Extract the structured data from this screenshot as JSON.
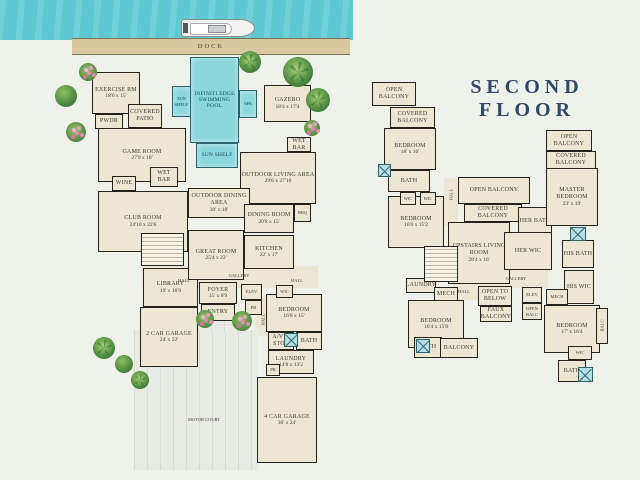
{
  "scene": {
    "dock_label": "DOCK",
    "second_floor_title": "SECOND FLOOR"
  },
  "palette": {
    "water": "#5fc9d3",
    "pool": "#8ad6dd",
    "room_fill": "#ece6d3",
    "wall": "#23231c",
    "background": "#eef2eb",
    "dock": "#d8c7a0",
    "title_navy": "#30486a"
  },
  "first_floor": {
    "rooms": [
      {
        "id": "hall-slab",
        "x": 142,
        "y": 266,
        "w": 176,
        "h": 22,
        "type": "slab"
      },
      {
        "id": "hall-slab-vert",
        "x": 255,
        "y": 296,
        "w": 14,
        "h": 40,
        "type": "slab"
      },
      {
        "id": "motor-court",
        "x": 134,
        "y": 330,
        "w": 124,
        "h": 140,
        "type": "paved"
      },
      {
        "id": "entry-walk",
        "x": 198,
        "y": 320,
        "w": 40,
        "h": 12,
        "type": "paved"
      },
      {
        "id": "exercise-rm",
        "label": "EXERCISE RM",
        "dims": "18'6 x 15'",
        "x": 92,
        "y": 72,
        "w": 48,
        "h": 42,
        "type": "room"
      },
      {
        "id": "pwdr",
        "label": "PWDR",
        "x": 95,
        "y": 114,
        "w": 28,
        "h": 15,
        "type": "room"
      },
      {
        "id": "covered-patio",
        "label": "COVERED PATIO",
        "x": 128,
        "y": 104,
        "w": 34,
        "h": 24,
        "type": "room"
      },
      {
        "id": "game-room",
        "label": "GAME ROOM",
        "dims": "27'9 x 18'",
        "x": 98,
        "y": 128,
        "w": 88,
        "h": 54,
        "type": "room"
      },
      {
        "id": "wine",
        "label": "WINE",
        "x": 112,
        "y": 176,
        "w": 24,
        "h": 15,
        "type": "room"
      },
      {
        "id": "wet-bar-1",
        "label": "WET BAR",
        "x": 150,
        "y": 167,
        "w": 28,
        "h": 20,
        "type": "room"
      },
      {
        "id": "club-room",
        "label": "CLUB ROOM",
        "dims": "24'10 x 22'6",
        "x": 98,
        "y": 191,
        "w": 90,
        "h": 61,
        "type": "room"
      },
      {
        "id": "library",
        "label": "LIBRARY",
        "dims": "19' x 16'9",
        "x": 143,
        "y": 268,
        "w": 55,
        "h": 39,
        "type": "room"
      },
      {
        "id": "two-car-garage",
        "label": "2 CAR GARAGE",
        "dims": "24' x 22'",
        "x": 140,
        "y": 307,
        "w": 58,
        "h": 60,
        "type": "room"
      },
      {
        "id": "gazebo",
        "label": "GAZEBO",
        "dims": "18'4 x 17'4",
        "x": 264,
        "y": 85,
        "w": 47,
        "h": 37,
        "type": "room"
      },
      {
        "id": "outdoor-living",
        "label": "OUTDOOR LIVING AREA",
        "dims": "29'6 x 27'10",
        "x": 240,
        "y": 152,
        "w": 76,
        "h": 52,
        "type": "room"
      },
      {
        "id": "wet-bar-2",
        "label": "WET BAR",
        "x": 287,
        "y": 137,
        "w": 24,
        "h": 15,
        "type": "room"
      },
      {
        "id": "outdoor-dining",
        "label": "OUTDOOR DINING AREA",
        "dims": "30' x 18'",
        "x": 188,
        "y": 188,
        "w": 62,
        "h": 30,
        "type": "room"
      },
      {
        "id": "dining-room",
        "label": "DINING ROOM",
        "dims": "20'8 x 15'",
        "x": 244,
        "y": 204,
        "w": 50,
        "h": 29,
        "type": "room"
      },
      {
        "id": "bbq",
        "label": "BBQ",
        "x": 294,
        "y": 204,
        "w": 17,
        "h": 18,
        "type": "room"
      },
      {
        "id": "kitchen",
        "label": "KITCHEN",
        "dims": "22' x 17'",
        "x": 244,
        "y": 235,
        "w": 50,
        "h": 34,
        "type": "room"
      },
      {
        "id": "great-room",
        "label": "GREAT ROOM",
        "dims": "25'4 x 22'",
        "x": 188,
        "y": 230,
        "w": 56,
        "h": 50,
        "type": "room"
      },
      {
        "id": "foyer",
        "label": "FOYER",
        "dims": "15' x 8'9",
        "x": 199,
        "y": 282,
        "w": 38,
        "h": 22,
        "type": "room"
      },
      {
        "id": "entry",
        "label": "ENTRY",
        "x": 201,
        "y": 304,
        "w": 34,
        "h": 17,
        "type": "room"
      },
      {
        "id": "elev",
        "label": "ELEV",
        "x": 241,
        "y": 284,
        "w": 21,
        "h": 16,
        "type": "room"
      },
      {
        "id": "pr-1",
        "label": "PR",
        "x": 245,
        "y": 300,
        "w": 17,
        "h": 15,
        "type": "room"
      },
      {
        "id": "bedroom-1",
        "label": "BEDROOM",
        "dims": "16'8 x 15'",
        "x": 266,
        "y": 294,
        "w": 56,
        "h": 38,
        "type": "room"
      },
      {
        "id": "wic-1",
        "label": "WIC",
        "x": 276,
        "y": 285,
        "w": 17,
        "h": 13,
        "type": "room"
      },
      {
        "id": "av-stor",
        "label": "A/V & STOR",
        "x": 268,
        "y": 332,
        "w": 26,
        "h": 18,
        "type": "room"
      },
      {
        "id": "bath-1",
        "label": "BATH",
        "x": 296,
        "y": 332,
        "w": 26,
        "h": 18,
        "type": "room"
      },
      {
        "id": "laundry",
        "label": "LAUNDRY",
        "dims": "14'8 x 13'2",
        "x": 268,
        "y": 350,
        "w": 46,
        "h": 24,
        "type": "room"
      },
      {
        "id": "pr-2",
        "label": "PR",
        "x": 266,
        "y": 364,
        "w": 14,
        "h": 12,
        "type": "room"
      },
      {
        "id": "four-car-garage",
        "label": "4 CAR GARAGE",
        "dims": "36' x 24'",
        "x": 257,
        "y": 377,
        "w": 60,
        "h": 86,
        "type": "room"
      },
      {
        "id": "sun-shelf-left",
        "label": "SUN SHELF",
        "x": 172,
        "y": 86,
        "w": 19,
        "h": 31,
        "type": "pool"
      },
      {
        "id": "pool",
        "label": "INFINITI EDGE SWIMMING POOL",
        "x": 190,
        "y": 57,
        "w": 49,
        "h": 86,
        "type": "pool"
      },
      {
        "id": "spa",
        "label": "SPA",
        "x": 239,
        "y": 90,
        "w": 18,
        "h": 28,
        "type": "pool"
      },
      {
        "id": "sun-shelf-bottom",
        "label": "SUN SHELF",
        "x": 196,
        "y": 143,
        "w": 42,
        "h": 25,
        "type": "pool"
      },
      {
        "id": "stairs-1",
        "x": 141,
        "y": 233,
        "w": 43,
        "h": 33,
        "type": "stairs"
      },
      {
        "id": "shower-1",
        "x": 284,
        "y": 333,
        "w": 14,
        "h": 14,
        "type": "shower"
      },
      {
        "id": "hall-1",
        "label": "HALL",
        "x": 170,
        "y": 276,
        "w": 28,
        "h": 10,
        "type": "label"
      },
      {
        "id": "gallery-1",
        "label": "GALLERY",
        "x": 221,
        "y": 271,
        "w": 36,
        "h": 10,
        "type": "label"
      },
      {
        "id": "hall-2",
        "label": "HALL",
        "x": 283,
        "y": 276,
        "w": 28,
        "h": 10,
        "type": "label"
      },
      {
        "id": "hall-vert",
        "label": "HALL",
        "x": 258,
        "y": 306,
        "w": 10,
        "h": 28,
        "type": "label",
        "vertical": true
      },
      {
        "id": "motor-court-label",
        "label": "MOTOR COURT",
        "x": 166,
        "y": 414,
        "w": 76,
        "h": 11,
        "type": "label"
      }
    ]
  },
  "second_floor": {
    "rooms": [
      {
        "id": "gallery-slab",
        "x": 452,
        "y": 268,
        "w": 96,
        "h": 20,
        "type": "slab"
      },
      {
        "id": "hall-slab-a",
        "x": 444,
        "y": 178,
        "w": 14,
        "h": 48,
        "type": "slab"
      },
      {
        "id": "hall-slab-b",
        "x": 452,
        "y": 284,
        "w": 28,
        "h": 16,
        "type": "slab"
      },
      {
        "id": "open-balcony-1",
        "label": "OPEN BALCONY",
        "x": 372,
        "y": 82,
        "w": 44,
        "h": 24,
        "type": "balcony"
      },
      {
        "id": "covered-balcony-1",
        "label": "COVERED BALCONY",
        "x": 390,
        "y": 107,
        "w": 45,
        "h": 21,
        "type": "balcony"
      },
      {
        "id": "bedroom-18x16",
        "label": "BEDROOM",
        "dims": "18' x 16'",
        "x": 384,
        "y": 128,
        "w": 52,
        "h": 42,
        "type": "room"
      },
      {
        "id": "bath-2",
        "label": "BATH",
        "x": 388,
        "y": 170,
        "w": 42,
        "h": 22,
        "type": "room"
      },
      {
        "id": "bedroom-166x152",
        "label": "BEDROOM",
        "dims": "16'6 x 15'2",
        "x": 388,
        "y": 196,
        "w": 56,
        "h": 52,
        "type": "room"
      },
      {
        "id": "wic-a",
        "label": "WIC",
        "x": 400,
        "y": 192,
        "w": 16,
        "h": 13,
        "type": "room"
      },
      {
        "id": "wic-b",
        "label": "WIC",
        "x": 420,
        "y": 192,
        "w": 16,
        "h": 13,
        "type": "room"
      },
      {
        "id": "upstairs-living",
        "label": "UPSTAIRS LIVING ROOM",
        "dims": "28'4 x 16'",
        "x": 448,
        "y": 222,
        "w": 62,
        "h": 62,
        "type": "room"
      },
      {
        "id": "open-balcony-2",
        "label": "OPEN BALCONY",
        "x": 458,
        "y": 177,
        "w": 72,
        "h": 27,
        "type": "balcony"
      },
      {
        "id": "covered-balcony-2",
        "label": "COVERED BALCONY",
        "x": 464,
        "y": 204,
        "w": 58,
        "h": 18,
        "type": "balcony"
      },
      {
        "id": "her-bath",
        "label": "HER BATH",
        "x": 518,
        "y": 207,
        "w": 34,
        "h": 29,
        "type": "room"
      },
      {
        "id": "her-wic",
        "label": "HER WIC",
        "x": 504,
        "y": 232,
        "w": 48,
        "h": 38,
        "type": "room"
      },
      {
        "id": "master-bedroom",
        "label": "MASTER BEDROOM",
        "dims": "23' x 19'",
        "x": 546,
        "y": 168,
        "w": 52,
        "h": 58,
        "type": "room"
      },
      {
        "id": "open-balcony-3",
        "label": "OPEN BALCONY",
        "x": 546,
        "y": 130,
        "w": 46,
        "h": 21,
        "type": "balcony"
      },
      {
        "id": "covered-balcony-3",
        "label": "COVERED BALCONY",
        "x": 546,
        "y": 151,
        "w": 50,
        "h": 18,
        "type": "balcony"
      },
      {
        "id": "his-bath",
        "label": "HIS BATH",
        "x": 562,
        "y": 240,
        "w": 32,
        "h": 28,
        "type": "room"
      },
      {
        "id": "his-wic",
        "label": "HIS WIC",
        "x": 564,
        "y": 270,
        "w": 30,
        "h": 34,
        "type": "room"
      },
      {
        "id": "mech-1",
        "label": "MECH",
        "x": 546,
        "y": 289,
        "w": 22,
        "h": 16,
        "type": "room"
      },
      {
        "id": "open-to-below",
        "label": "OPEN TO BELOW",
        "x": 478,
        "y": 286,
        "w": 34,
        "h": 20,
        "type": "room"
      },
      {
        "id": "faux-balcony",
        "label": "FAUX BALCONY",
        "x": 480,
        "y": 306,
        "w": 32,
        "h": 16,
        "type": "balcony"
      },
      {
        "id": "elev-2",
        "label": "ELEV",
        "x": 522,
        "y": 287,
        "w": 20,
        "h": 16,
        "type": "room"
      },
      {
        "id": "open-balc",
        "label": "OPEN BALC",
        "x": 522,
        "y": 303,
        "w": 20,
        "h": 17,
        "type": "room"
      },
      {
        "id": "laundry-2",
        "label": "LAUNDRY",
        "x": 406,
        "y": 278,
        "w": 30,
        "h": 15,
        "type": "room"
      },
      {
        "id": "mech-2",
        "label": "MECH",
        "x": 434,
        "y": 287,
        "w": 24,
        "h": 15,
        "type": "room"
      },
      {
        "id": "bedroom-164x158",
        "label": "BEDROOM",
        "dims": "16'4 x 15'8",
        "x": 408,
        "y": 300,
        "w": 56,
        "h": 48,
        "type": "room"
      },
      {
        "id": "bath-3",
        "label": "BATH",
        "x": 414,
        "y": 337,
        "w": 28,
        "h": 21,
        "type": "room"
      },
      {
        "id": "balcony-1",
        "label": "BALCONY",
        "x": 440,
        "y": 338,
        "w": 38,
        "h": 20,
        "type": "balcony"
      },
      {
        "id": "bedroom-17x164",
        "label": "BEDROOM",
        "dims": "17' x 16'4",
        "x": 544,
        "y": 305,
        "w": 56,
        "h": 48,
        "type": "room"
      },
      {
        "id": "balc-strip",
        "label": "BALC",
        "x": 596,
        "y": 308,
        "w": 12,
        "h": 36,
        "type": "balcony",
        "vertical": true
      },
      {
        "id": "wic-2",
        "label": "WIC",
        "x": 568,
        "y": 346,
        "w": 24,
        "h": 14,
        "type": "room"
      },
      {
        "id": "bath-4",
        "label": "BATH",
        "x": 558,
        "y": 360,
        "w": 28,
        "h": 22,
        "type": "room"
      },
      {
        "id": "stairs-2",
        "x": 424,
        "y": 246,
        "w": 34,
        "h": 36,
        "type": "stairs"
      },
      {
        "id": "shower-2",
        "x": 570,
        "y": 227,
        "w": 16,
        "h": 14,
        "type": "shower"
      },
      {
        "id": "shower-3",
        "x": 416,
        "y": 339,
        "w": 14,
        "h": 14,
        "type": "shower"
      },
      {
        "id": "shower-4",
        "x": 578,
        "y": 367,
        "w": 15,
        "h": 15,
        "type": "shower"
      },
      {
        "id": "shower-5",
        "x": 378,
        "y": 164,
        "w": 13,
        "h": 13,
        "type": "shower"
      },
      {
        "id": "gallery-2",
        "label": "GALLERY",
        "x": 496,
        "y": 274,
        "w": 40,
        "h": 10,
        "type": "label"
      },
      {
        "id": "hall-3",
        "label": "HALL",
        "x": 452,
        "y": 287,
        "w": 24,
        "h": 10,
        "type": "label"
      },
      {
        "id": "hall-vert-2",
        "label": "HALL",
        "x": 446,
        "y": 182,
        "w": 10,
        "h": 26,
        "type": "label",
        "vertical": true
      }
    ]
  },
  "plants": [
    {
      "id": "plant-1",
      "kind": "flower",
      "x": 88,
      "y": 72,
      "r": 9
    },
    {
      "id": "plant-2",
      "kind": "bush",
      "x": 66,
      "y": 96,
      "r": 11
    },
    {
      "id": "plant-3",
      "kind": "flower",
      "x": 76,
      "y": 132,
      "r": 10
    },
    {
      "id": "plant-4",
      "kind": "palm",
      "x": 250,
      "y": 62,
      "r": 11
    },
    {
      "id": "plant-5",
      "kind": "palm",
      "x": 298,
      "y": 72,
      "r": 15
    },
    {
      "id": "plant-6",
      "kind": "palm",
      "x": 318,
      "y": 100,
      "r": 12
    },
    {
      "id": "plant-7",
      "kind": "flower",
      "x": 312,
      "y": 128,
      "r": 8
    },
    {
      "id": "plant-8",
      "kind": "palm",
      "x": 104,
      "y": 348,
      "r": 11
    },
    {
      "id": "plant-9",
      "kind": "bush",
      "x": 124,
      "y": 364,
      "r": 9
    },
    {
      "id": "plant-10",
      "kind": "palm",
      "x": 140,
      "y": 380,
      "r": 9
    },
    {
      "id": "plant-11",
      "kind": "flower",
      "x": 205,
      "y": 319,
      "r": 9
    },
    {
      "id": "plant-12",
      "kind": "flower",
      "x": 242,
      "y": 321,
      "r": 10
    }
  ]
}
